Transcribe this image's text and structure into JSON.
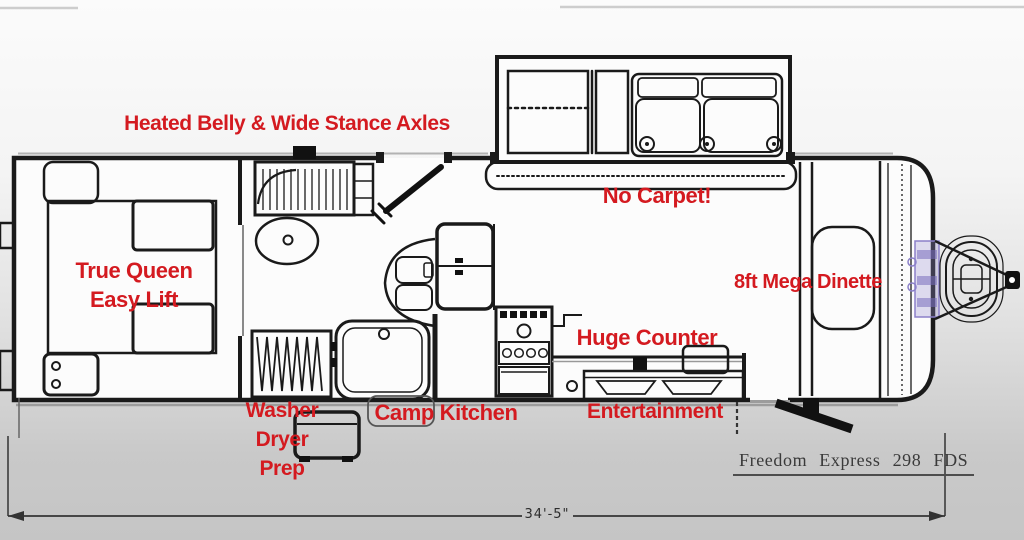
{
  "title": "Freedom Express 298 FDS travel trailer floor plan",
  "colors": {
    "label_red": "#d41a20",
    "line_dark": "#1a1a1a",
    "model_text": "#3a3a3a",
    "accent_purple": "#8b80c9"
  },
  "labels": {
    "heated_belly": "Heated Belly & Wide Stance Axles",
    "no_carpet": "No Carpet!",
    "true_queen_line1": "True Queen",
    "true_queen_line2": "Easy Lift",
    "mega_dinette": "8ft Mega Dinette",
    "huge_counter": "Huge Counter",
    "washer_line1": "Washer",
    "washer_line2": "Dryer",
    "washer_line3": "Prep",
    "camp_kitchen": "Camp Kitchen",
    "entertainment": "Entertainment"
  },
  "footer": {
    "model_name": "Freedom Express 298 FDS",
    "overall_length": "34'-5\""
  },
  "fixtures": [
    "queen-bed",
    "wardrobe",
    "linen-closet",
    "toilet",
    "shower-tub",
    "entry-door",
    "refrigerator",
    "kitchen-sink",
    "range-oven",
    "entertainment-center",
    "dinette-table",
    "sofa-slide-out",
    "bunk",
    "camp-kitchen-compartment",
    "propane-tanks",
    "a-frame-hitch",
    "entry-steps"
  ]
}
